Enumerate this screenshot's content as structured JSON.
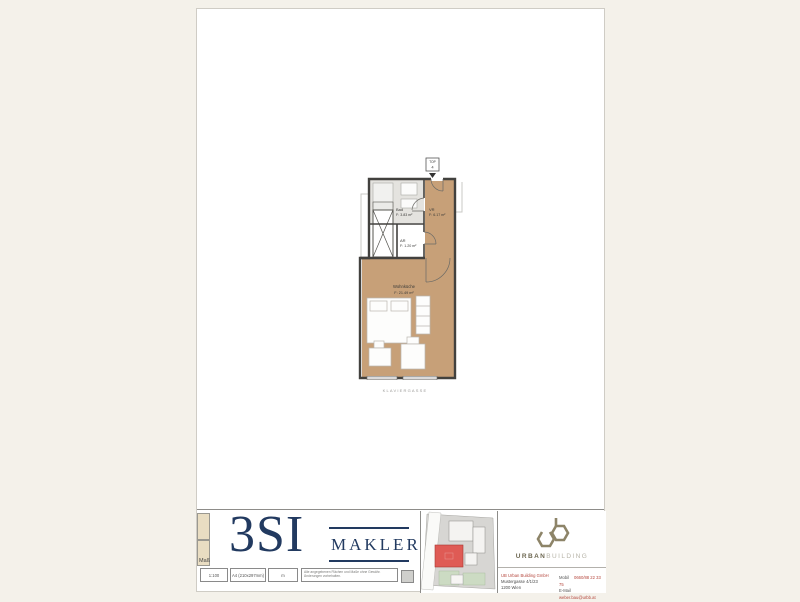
{
  "floor_plan": {
    "unit_label": {
      "top": "TOP",
      "number": "4"
    },
    "rooms": [
      {
        "name": "Bad",
        "area": "F: 3.83 m²"
      },
      {
        "name": "VR",
        "area": "F: 6.17 m²"
      },
      {
        "name": "AR",
        "area": "F: 1.20 m²"
      },
      {
        "name": "Wohnküche",
        "area": "F: 21.49 m²"
      }
    ],
    "street_label": "KLAVIERGASSE"
  },
  "title_block": {
    "broker": {
      "logo_main": "3SI",
      "logo_sub": "MAKLER"
    },
    "meta": {
      "label": "Maß",
      "scale": "1:100",
      "format": "A4 (210x297mm)",
      "unit": "m",
      "disclaimer": "Alle angegebenen Flächen und Maße ohne Gewähr. Änderungen vorbehalten."
    },
    "developer": {
      "logo_bold": "URBAN",
      "logo_light": "BUILDING",
      "company": "UB Urban Building GmbH",
      "address1": "Mustergasse 4/1/23",
      "address2": "1200 Wien",
      "mobile_label": "Mobil",
      "mobile_value": "0660/88 22 33 75",
      "email_label": "E-Mail",
      "email_value": "weber.bau@urbb.at"
    }
  },
  "colors": {
    "brand_navy": "#223a60",
    "floor_tan": "#c7a078",
    "site_highlight_red": "#df5b55",
    "developer_olive": "#8d8468",
    "background_cream": "#f4f1ea"
  }
}
